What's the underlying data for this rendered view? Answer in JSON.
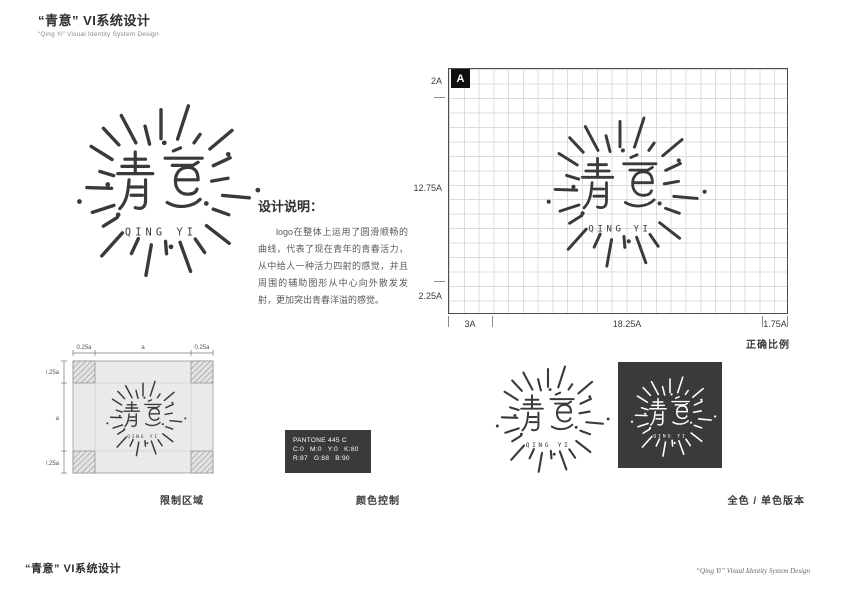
{
  "header": {
    "title": "“青意” VI系统设计",
    "subtitle": "“Qing Yi” Visual Identity System Design"
  },
  "logo": {
    "name_cn": "青意",
    "name_en": "QING YI"
  },
  "description": {
    "title": "设计说明：",
    "body": "logo在整体上运用了圆滑顺畅的曲线，代表了现在青年的青春活力，从中给人一种活力四射的感觉，并且周围的辅助图形从中心向外散发发射，更加突出青春洋溢的感觉。"
  },
  "proportion": {
    "marker": "A",
    "left_labels": [
      "2A",
      "12.75A",
      "2.25A"
    ],
    "bottom_labels": [
      "3A",
      "18.25A",
      "1.75A"
    ],
    "caption": "正确比例"
  },
  "clearspace": {
    "top_labels": [
      "0.25a",
      "a",
      "0.25a"
    ],
    "left_labels": [
      "0.25a",
      "a",
      "0.25a"
    ],
    "caption": "限制区域"
  },
  "color": {
    "pantone": "PANTONE 445 C",
    "cmyk": [
      "C:0",
      "M:0",
      "Y:0",
      "K:80"
    ],
    "rgb": [
      "R:87",
      "G:88",
      "B:90"
    ],
    "caption": "颜色控制",
    "swatch_hex": "#3A3A3C"
  },
  "versions": {
    "caption": "全色 / 单色版本"
  },
  "footer": {
    "left": "“青意” VI系统设计",
    "right": "“Qing Yi” Visual Identity System Design"
  }
}
